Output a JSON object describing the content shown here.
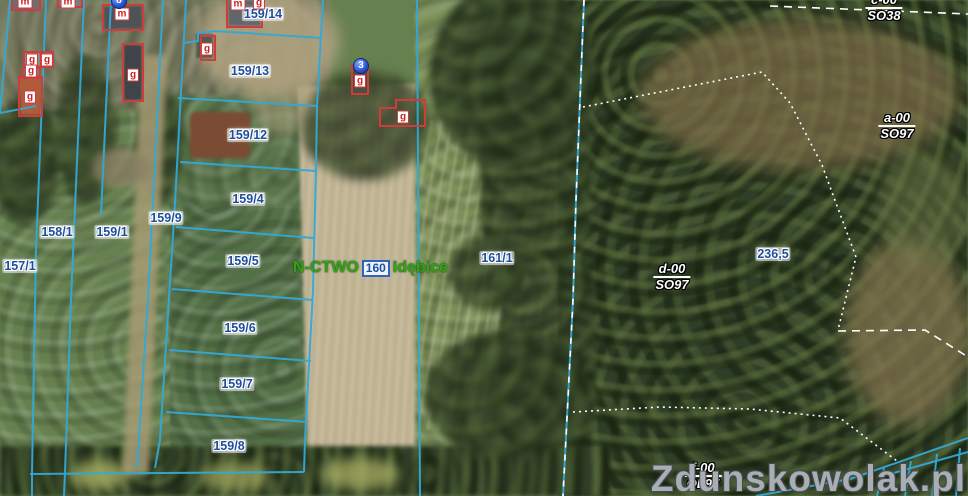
{
  "map": {
    "watermark": "Zdunskowolak.pl",
    "colors": {
      "parcel_line": "#33a9d6",
      "parcel_text": "#1d4e9e",
      "building_outline": "#d03c3c",
      "building_text": "#cf2020",
      "forest_boundary": "#ffffff",
      "forest_text": "#ffffff",
      "green_text": "#33a315",
      "marker_blue": "#2a52c8",
      "watermark_gray": "#babfc5"
    },
    "parcel_labels": [
      {
        "text": "157/1",
        "x": 20,
        "y": 266
      },
      {
        "text": "158/1",
        "x": 57,
        "y": 232
      },
      {
        "text": "159/1",
        "x": 112,
        "y": 232
      },
      {
        "text": "159/9",
        "x": 166,
        "y": 218
      },
      {
        "text": "159/4",
        "x": 248,
        "y": 199
      },
      {
        "text": "159/5",
        "x": 243,
        "y": 261
      },
      {
        "text": "159/6",
        "x": 240,
        "y": 328
      },
      {
        "text": "159/7",
        "x": 237,
        "y": 384
      },
      {
        "text": "159/8",
        "x": 229,
        "y": 446
      },
      {
        "text": "159/12",
        "x": 248,
        "y": 135
      },
      {
        "text": "159/13",
        "x": 250,
        "y": 71
      },
      {
        "text": "159/14",
        "x": 263,
        "y": 14
      },
      {
        "text": "161/1",
        "x": 497,
        "y": 258
      }
    ],
    "elevation_label": {
      "text": "236,5",
      "x": 773,
      "y": 254
    },
    "building_labels": [
      {
        "text": "m",
        "x": 25,
        "y": 2
      },
      {
        "text": "m",
        "x": 68,
        "y": 2
      },
      {
        "text": "m",
        "x": 122,
        "y": 14
      },
      {
        "text": "m",
        "x": 238,
        "y": 4
      },
      {
        "text": "g",
        "x": 259,
        "y": 3
      },
      {
        "text": "g",
        "x": 32,
        "y": 60
      },
      {
        "text": "g",
        "x": 47,
        "y": 60
      },
      {
        "text": "g",
        "x": 31,
        "y": 71
      },
      {
        "text": "g",
        "x": 30,
        "y": 97
      },
      {
        "text": "g",
        "x": 133,
        "y": 75
      },
      {
        "text": "g",
        "x": 207,
        "y": 49
      },
      {
        "text": "g",
        "x": 360,
        "y": 81
      },
      {
        "text": "g",
        "x": 403,
        "y": 117
      }
    ],
    "forest_labels": [
      {
        "top": "c-00",
        "bottom": "SO38",
        "x": 884,
        "y": 8
      },
      {
        "top": "a-00",
        "bottom": "SO97",
        "x": 897,
        "y": 126
      },
      {
        "top": "d-00",
        "bottom": "SO97",
        "x": 672,
        "y": 277
      },
      {
        "top": "f-00",
        "bottom": "OL97",
        "x": 703,
        "y": 476
      }
    ],
    "markers": [
      {
        "label": "3",
        "x": 361,
        "y": 66
      },
      {
        "label": "8",
        "x": 119,
        "y": 1
      }
    ],
    "green_label": {
      "prefix": "N-CTWO",
      "box": "160",
      "suffix": "Idębice",
      "x": 293,
      "y": 268
    }
  }
}
